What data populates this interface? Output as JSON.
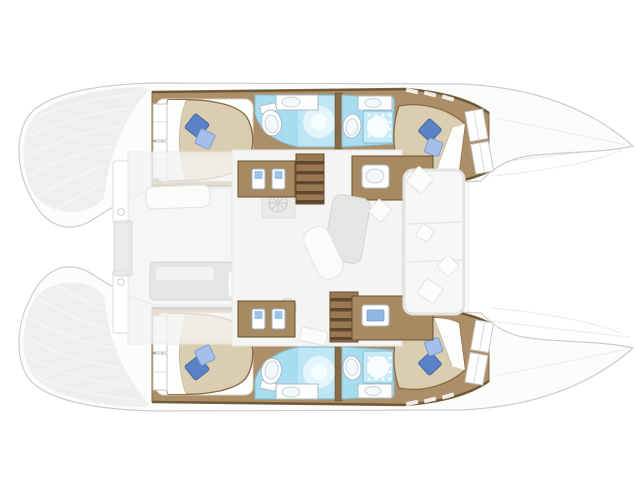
{
  "canvas": {
    "width": 640,
    "height": 479,
    "background": "#ffffff"
  },
  "palette": {
    "hull_fill": "#fcfcfb",
    "hull_outline": "#cccccb",
    "hull_shade": "#ececea",
    "wood_floor": "#ac8f68",
    "wood_dark": "#886a46",
    "wood_trim": "#66502f",
    "counter_wood": "#a78a61",
    "stair_light": "#9a7850",
    "stair_dark": "#5e462f",
    "bed_fill": "#dbcdaf",
    "bed_stroke": "#8a6c4a",
    "sheet_white": "#ffffff",
    "pillow_dark": "#5b82c6",
    "pillow_light": "#a5c0e8",
    "bath_floor": "#a8dcf0",
    "bath_tile": "#c6eaf6",
    "bath_stroke": "#86bcd2",
    "fixture_fill": "#fefefe",
    "fixture_stroke": "#b0c0c8",
    "saloon_floor": "#f4f4f2",
    "furniture_gray": "#e5e5e3",
    "furniture_stroke": "#d4d4d2"
  },
  "vessel": {
    "kind": "catamaran-floor-plan-overhead",
    "hulls": [
      {
        "name": "top-hull",
        "rooms": [
          "aft-double-cabin",
          "aft-bathroom",
          "forward-bathroom-with-shower",
          "forward-double-cabin"
        ]
      },
      {
        "name": "bottom-hull",
        "rooms": [
          "aft-double-cabin",
          "aft-bathroom",
          "forward-bathroom-with-shower",
          "forward-double-cabin"
        ]
      }
    ],
    "saloon": [
      "galley-counter-aft",
      "galley-counter-forward-with-sink",
      "nav-counter",
      "companionway-stairs-top-hull",
      "companionway-stairs-bottom-hull",
      "dinette-table",
      "chaise-longue",
      "ceiling-hatch-fans"
    ],
    "aft_cockpit": [
      "bench-seat",
      "cockpit-table",
      "stool",
      "transom-step-top",
      "transom-step-bottom",
      "aft-platform"
    ],
    "foredeck": [
      "forward-cockpit-bench",
      "seat-cushions",
      "trampoline-area"
    ]
  },
  "icons": {
    "toilet": "oval-bowl-with-tank",
    "sink": "oval-basin-on-counter",
    "shower": "dotted-drain-grid-with-glow",
    "hatch_fan": "circle-with-x-spokes",
    "pillow": "rotated-square",
    "stairs": "striped-treads"
  }
}
